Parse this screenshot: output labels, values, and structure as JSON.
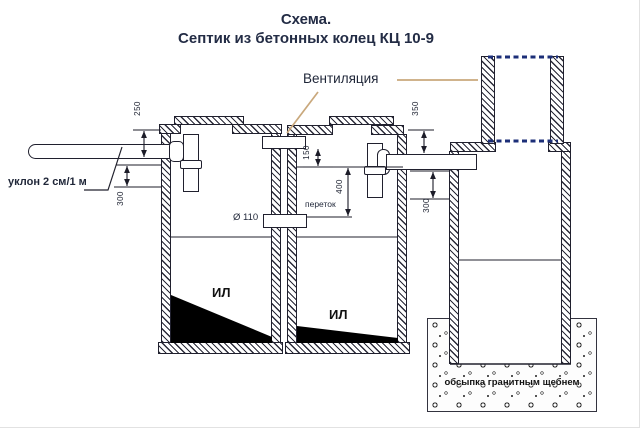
{
  "title": {
    "line1": "Схема.",
    "line2": "Септик из бетонных колец КЦ 10-9"
  },
  "annotations": {
    "ventilation": "Вентиляция",
    "slope": "уклон 2 см/1 м",
    "overflow": "переток",
    "pipe_diameter": "Ø 110",
    "gravel_backfill": "обсыпка гранитным щебнем"
  },
  "tanks": {
    "tank1_sludge": "ИЛ",
    "tank2_sludge": "ИЛ"
  },
  "dimensions_mm": {
    "inlet_pipe_depth": "250",
    "tank1_tee_drop": "300",
    "vent_to_pipe": "150",
    "pipe_to_overflow": "400",
    "outlet_pipe_depth": "350",
    "tank3_pipe_drop": "300"
  },
  "colors": {
    "line": "#20202e",
    "text": "#1f2638",
    "title": "#232c45",
    "leader": "#c9a87c",
    "accent_dashed": "#1c2f78",
    "sludge": "#000000"
  }
}
